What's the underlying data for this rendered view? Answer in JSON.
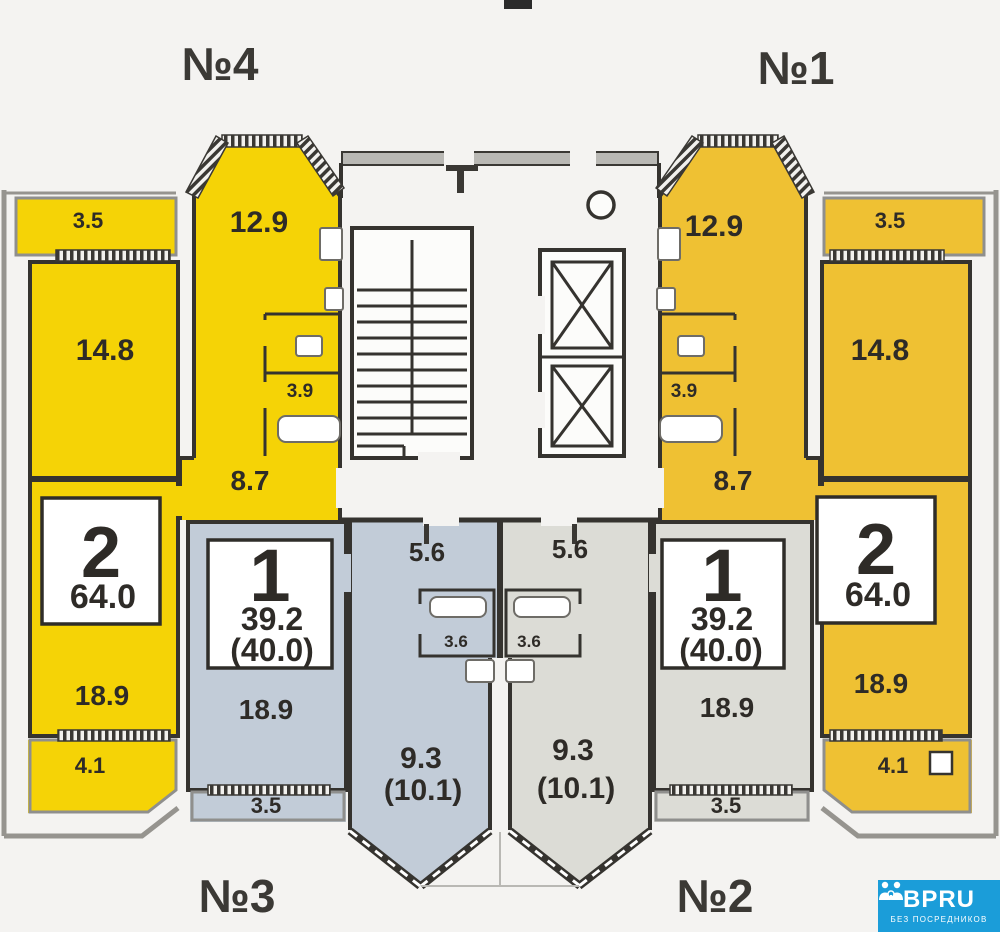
{
  "colors": {
    "apt4": "#F5D306",
    "apt1": "#EFC133",
    "apt3": "#C2CCD8",
    "apt2": "#DCDCD6",
    "walls": "#35332F",
    "outer_wall": "#96948F",
    "background": "#F4F3F1",
    "logo_bg": "#1B9DD9"
  },
  "apartments": {
    "apt4": {
      "number": "№4",
      "type": "2",
      "area_total": "64.0",
      "balcony_top": "3.5",
      "kitchen": "12.9",
      "bedroom": "14.8",
      "bathroom": "3.9",
      "hall": "8.7",
      "living": "18.9",
      "balcony_bottom": "4.1"
    },
    "apt1": {
      "number": "№1",
      "type": "2",
      "area_total": "64.0",
      "balcony_top": "3.5",
      "kitchen": "12.9",
      "bedroom": "14.8",
      "bathroom": "3.9",
      "hall": "8.7",
      "living": "18.9",
      "balcony_bottom": "4.1"
    },
    "apt3": {
      "number": "№3",
      "type": "1",
      "area_living": "39.2",
      "area_total": "(40.0)",
      "living": "18.9",
      "hall": "5.6",
      "bathroom": "3.6",
      "loggia": "9.3",
      "loggia_total": "(10.1)",
      "balcony": "3.5"
    },
    "apt2": {
      "number": "№2",
      "type": "1",
      "area_living": "39.2",
      "area_total": "(40.0)",
      "living": "18.9",
      "hall": "5.6",
      "bathroom": "3.6",
      "loggia": "9.3",
      "loggia_total": "(10.1)",
      "balcony": "3.5"
    }
  },
  "logo": {
    "brand": "BPRU",
    "tagline": "БЕЗ ПОСРЕДНИКОВ"
  }
}
